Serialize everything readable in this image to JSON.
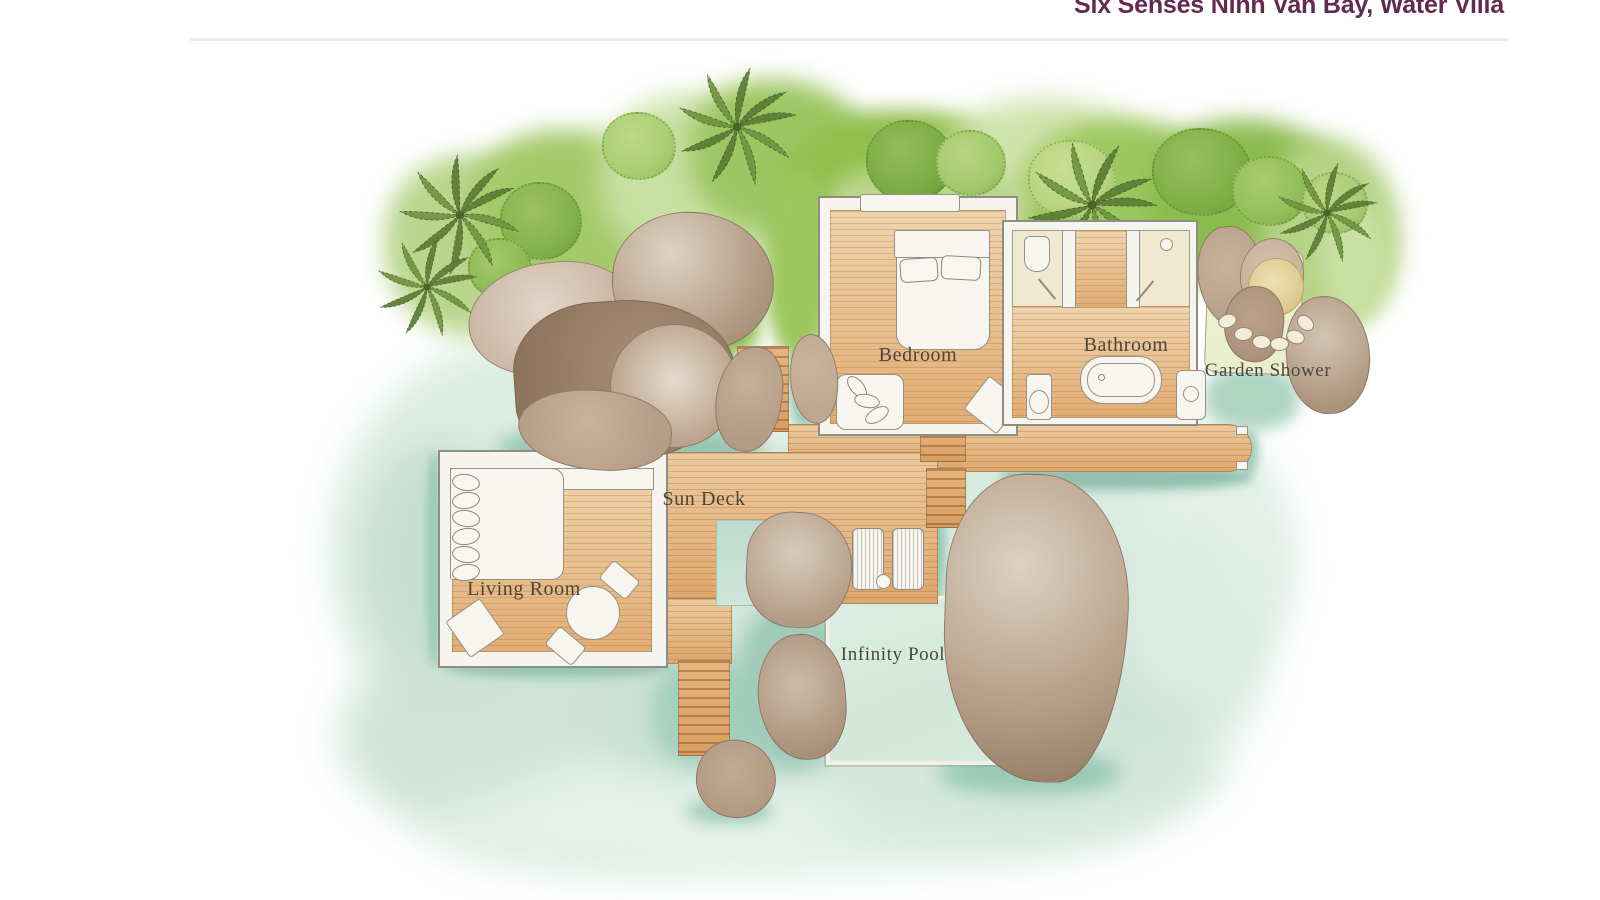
{
  "header": {
    "title": "Six Senses Ninh Van Bay, Water Villa"
  },
  "floorplan": {
    "rooms": {
      "bedroom": "Bedroom",
      "bathroom": "Bathroom",
      "garden_shower": "Garden Shower",
      "sun_deck": "Sun Deck",
      "living_room": "Living Room",
      "infinity_pool": "Infinity Pool"
    },
    "colors": {
      "title_text": "#63294f",
      "label_text": "#4c463b",
      "water": "#d8ebe0",
      "water_shadow": "#8fc0ae",
      "wood": "#e2ab71",
      "rock": "#b49c86",
      "foliage": "#96c254",
      "pool": "#d7ebdf",
      "paper": "#ffffff"
    }
  }
}
